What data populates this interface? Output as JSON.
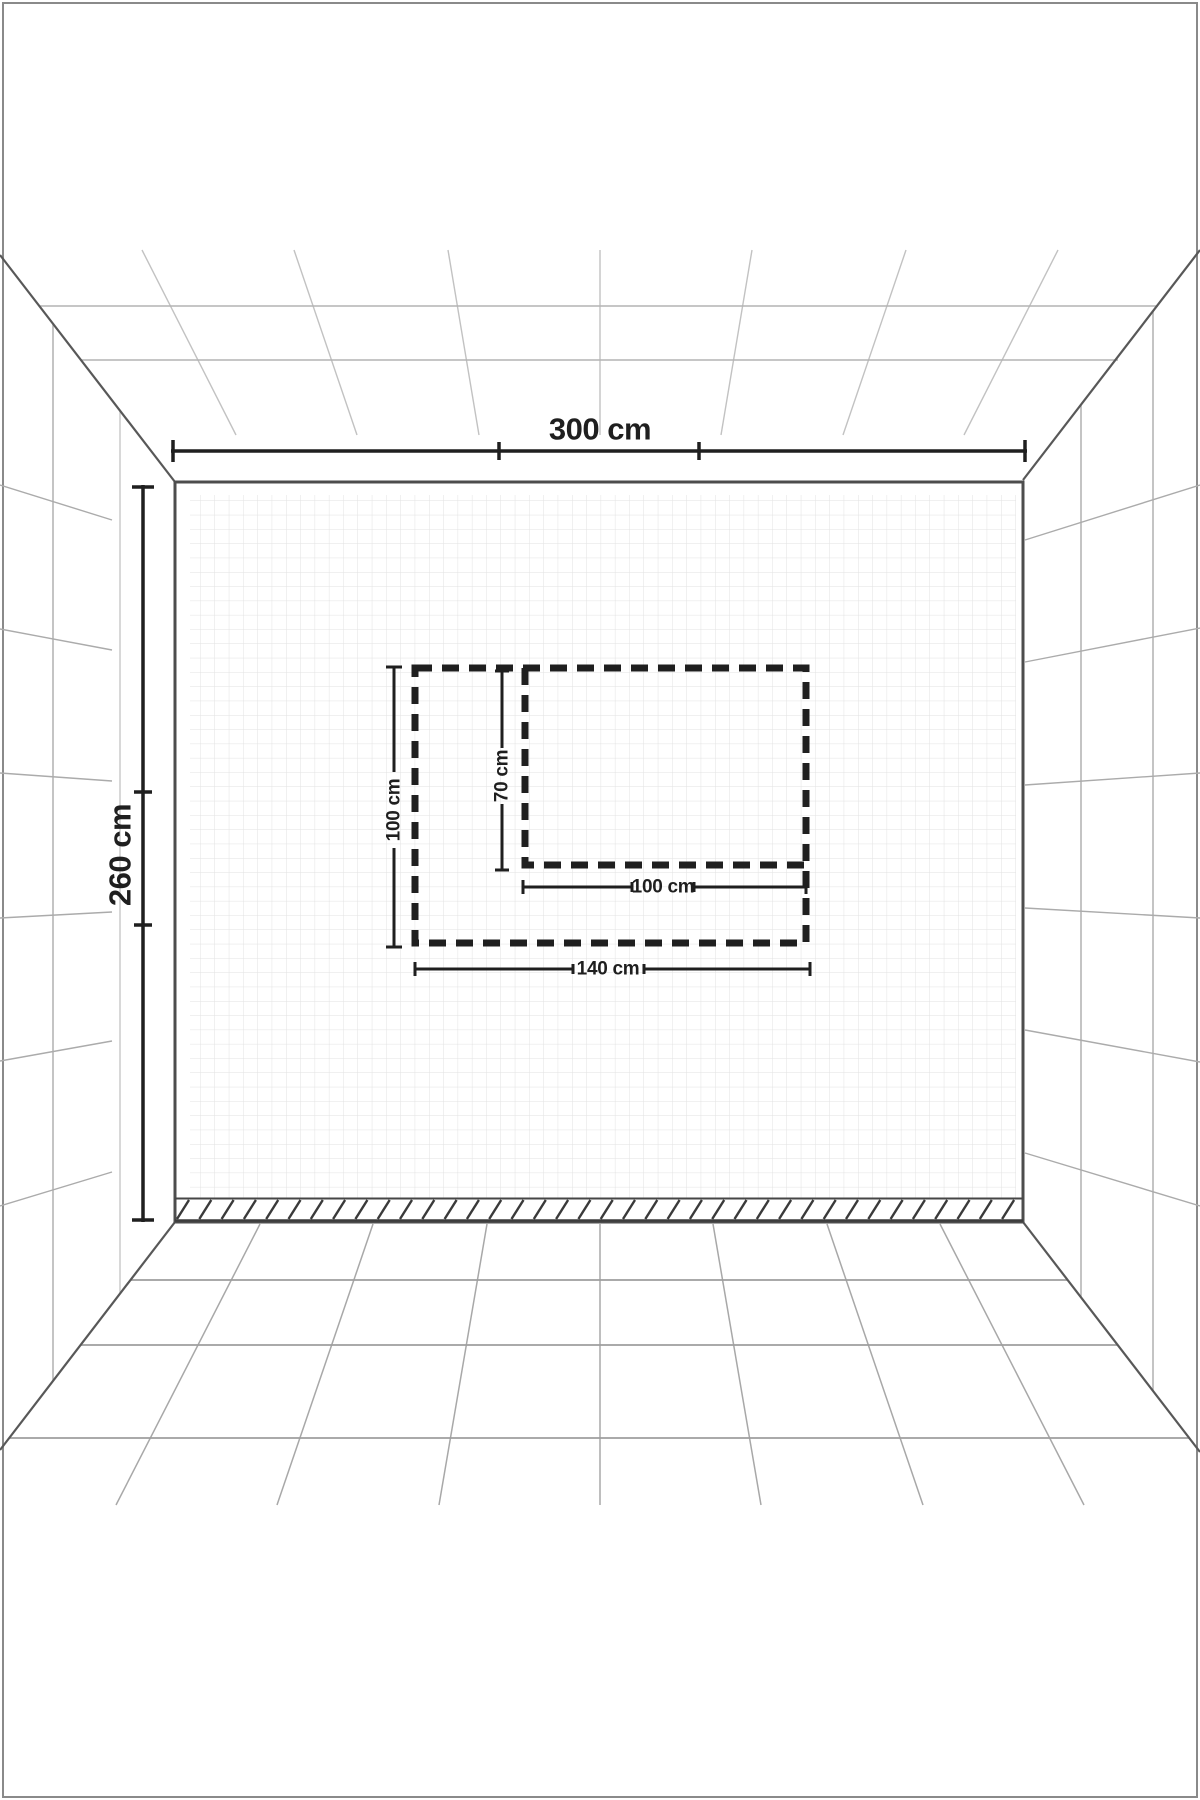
{
  "diagram": {
    "type": "room-perspective-size-guide",
    "room": {
      "width_label": "300 cm",
      "height_label": "260 cm",
      "width_cm": 300,
      "height_cm": 260
    },
    "marked_zones": {
      "outer_rect": {
        "width_label": "140 cm",
        "height_label": "100 cm",
        "width_cm": 140,
        "height_cm": 100
      },
      "inner_rect": {
        "width_label": "100 cm",
        "height_label": "70 cm",
        "width_cm": 100,
        "height_cm": 70
      }
    }
  },
  "labels": {
    "wall_width": "300 cm",
    "wall_height": "260 cm",
    "outer_height": "100 cm",
    "inner_height": "70 cm",
    "inner_width": "100 cm",
    "outer_width": "140 cm"
  },
  "colors": {
    "background": "#ffffff",
    "ink": "#1f1f1f",
    "wall_edge": "#4d4d4d",
    "corner_diagonal": "#585858",
    "grid": "#e2e2e2",
    "perspective_line": "#a8a8a8",
    "ceiling_line": "#c2c2c2",
    "frame_border": "#8a8a8a",
    "hatch": "#3a3a3a"
  }
}
